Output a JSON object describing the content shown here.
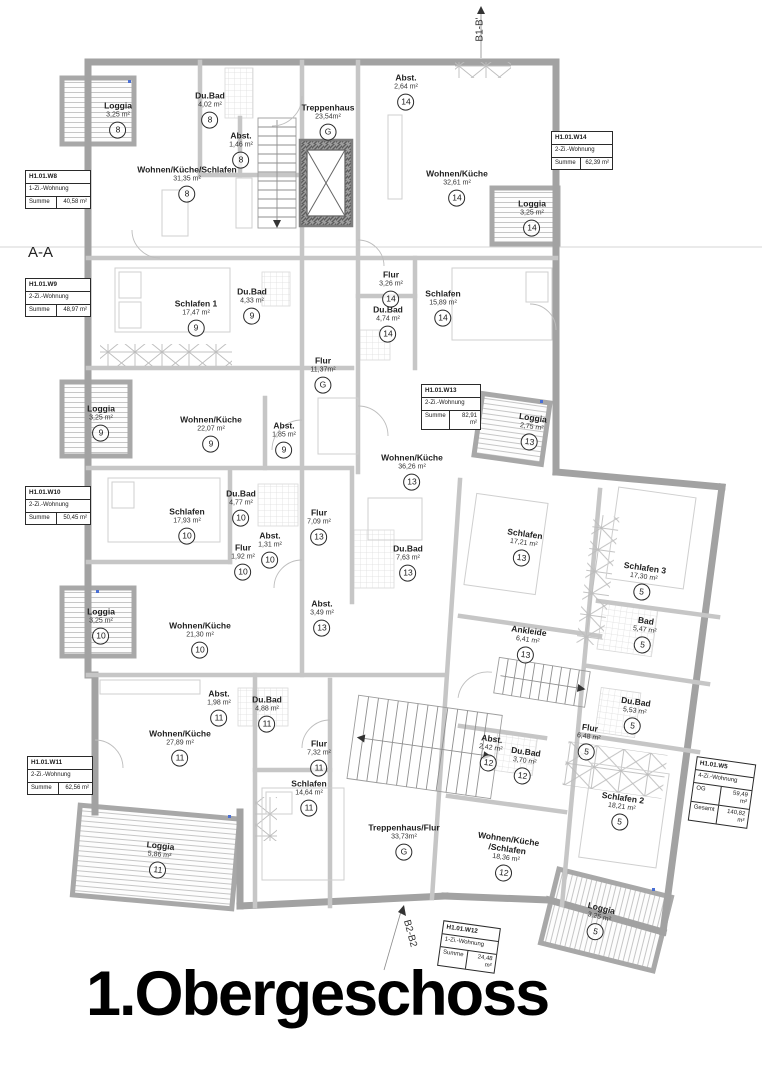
{
  "title": "1.Obergeschoss",
  "section_labels": {
    "aa": "A-A",
    "b1": "B1-B'",
    "b2": "B2-B2"
  },
  "apartment_boxes": [
    {
      "id": "H1.01.W8",
      "type": "1-Zi.-Wohnung",
      "rows": [
        [
          "Summe",
          "40,58 m²"
        ]
      ],
      "x": 25,
      "y": 170,
      "rot": 0,
      "w": 64
    },
    {
      "id": "H1.01.W9",
      "type": "2-Zi.-Wohnung",
      "rows": [
        [
          "Summe",
          "48,97 m²"
        ]
      ],
      "x": 25,
      "y": 278,
      "rot": 0,
      "w": 64
    },
    {
      "id": "H1.01.W10",
      "type": "2-Zi.-Wohnung",
      "rows": [
        [
          "Summe",
          "50,45 m²"
        ]
      ],
      "x": 25,
      "y": 486,
      "rot": 0,
      "w": 64
    },
    {
      "id": "H1.01.W11",
      "type": "2-Zi.-Wohnung",
      "rows": [
        [
          "Summe",
          "62,56 m²"
        ]
      ],
      "x": 27,
      "y": 756,
      "rot": 0,
      "w": 64
    },
    {
      "id": "H1.01.W13",
      "type": "2-Zi.-Wohnung",
      "rows": [
        [
          "Summe",
          "82,91 m²"
        ]
      ],
      "x": 421,
      "y": 384,
      "rot": 0,
      "w": 58
    },
    {
      "id": "H1.01.W14",
      "type": "2-Zi.-Wohnung",
      "rows": [
        [
          "Summe",
          "62,39 m²"
        ]
      ],
      "x": 551,
      "y": 131,
      "rot": 0,
      "w": 60
    },
    {
      "id": "H1.01.W5",
      "type": "4-Zi.-Wohnung",
      "rows": [
        [
          "OG",
          "59,49 m²"
        ],
        [
          "Gesamt",
          "140,82 m²"
        ]
      ],
      "x": 692,
      "y": 760,
      "rot": 8,
      "w": 58
    },
    {
      "id": "H1.01.W12",
      "type": "1-Zi.-Wohnung",
      "rows": [
        [
          "Summe",
          "24,48 m²"
        ]
      ],
      "x": 440,
      "y": 924,
      "rot": 8,
      "w": 56
    }
  ],
  "rooms": [
    {
      "name": "Loggia",
      "area": "3,25 m²",
      "unit": "8",
      "x": 118,
      "y": 120,
      "rot": 0
    },
    {
      "name": "Du.Bad",
      "area": "4,02 m²",
      "unit": "8",
      "x": 210,
      "y": 110,
      "rot": 0
    },
    {
      "name": "Abst.",
      "area": "1,46 m²",
      "unit": "8",
      "x": 241,
      "y": 150,
      "rot": 0
    },
    {
      "name": "Wohnen/Küche/Schlafen",
      "area": "31,35 m²",
      "unit": "8",
      "x": 187,
      "y": 184,
      "rot": 0
    },
    {
      "name": "Treppenhaus",
      "area": "23,54m²",
      "unit": "G",
      "x": 328,
      "y": 122,
      "rot": 0
    },
    {
      "name": "Abst.",
      "area": "2,64 m²",
      "unit": "14",
      "x": 406,
      "y": 92,
      "rot": 0
    },
    {
      "name": "Wohnen/Küche",
      "area": "32,61 m²",
      "unit": "14",
      "x": 457,
      "y": 188,
      "rot": 0
    },
    {
      "name": "Loggia",
      "area": "3,25 m²",
      "unit": "14",
      "x": 532,
      "y": 218,
      "rot": 0
    },
    {
      "name": "Schlafen 1",
      "area": "17,47 m²",
      "unit": "9",
      "x": 196,
      "y": 318,
      "rot": 0
    },
    {
      "name": "Du.Bad",
      "area": "4,33 m²",
      "unit": "9",
      "x": 252,
      "y": 306,
      "rot": 0
    },
    {
      "name": "Flur",
      "area": "3,26 m²",
      "unit": "14",
      "x": 391,
      "y": 289,
      "rot": 0
    },
    {
      "name": "Du.Bad",
      "area": "4,74 m²",
      "unit": "14",
      "x": 388,
      "y": 324,
      "rot": 0
    },
    {
      "name": "Schlafen",
      "area": "15,89 m²",
      "unit": "14",
      "x": 443,
      "y": 308,
      "rot": 0
    },
    {
      "name": "Flur",
      "area": "11,37m²",
      "unit": "G",
      "x": 323,
      "y": 375,
      "rot": 0
    },
    {
      "name": "Loggia",
      "area": "3,25 m²",
      "unit": "9",
      "x": 101,
      "y": 423,
      "rot": 0
    },
    {
      "name": "Wohnen/Küche",
      "area": "22,07 m²",
      "unit": "9",
      "x": 211,
      "y": 434,
      "rot": 0
    },
    {
      "name": "Abst.",
      "area": "1,85 m²",
      "unit": "9",
      "x": 284,
      "y": 440,
      "rot": 0
    },
    {
      "name": "Wohnen/Küche",
      "area": "36,26 m²",
      "unit": "13",
      "x": 412,
      "y": 472,
      "rot": 0
    },
    {
      "name": "Loggia",
      "area": "2,75 m²",
      "unit": "13",
      "x": 531,
      "y": 432,
      "rot": 8
    },
    {
      "name": "Schlafen",
      "area": "17,93 m²",
      "unit": "10",
      "x": 187,
      "y": 526,
      "rot": 0
    },
    {
      "name": "Du.Bad",
      "area": "4,77 m²",
      "unit": "10",
      "x": 241,
      "y": 508,
      "rot": 0
    },
    {
      "name": "Abst.",
      "area": "1,31 m²",
      "unit": "10",
      "x": 270,
      "y": 550,
      "rot": 0
    },
    {
      "name": "Flur",
      "area": "1,92 m²",
      "unit": "10",
      "x": 243,
      "y": 562,
      "rot": 0
    },
    {
      "name": "Flur",
      "area": "7,09 m²",
      "unit": "13",
      "x": 319,
      "y": 527,
      "rot": 0
    },
    {
      "name": "Du.Bad",
      "area": "7,63 m²",
      "unit": "13",
      "x": 408,
      "y": 563,
      "rot": 0
    },
    {
      "name": "Schlafen",
      "area": "17,21 m²",
      "unit": "13",
      "x": 523,
      "y": 548,
      "rot": 8
    },
    {
      "name": "Loggia",
      "area": "3,25 m²",
      "unit": "10",
      "x": 101,
      "y": 626,
      "rot": 0
    },
    {
      "name": "Abst.",
      "area": "3,49 m²",
      "unit": "13",
      "x": 322,
      "y": 618,
      "rot": 0
    },
    {
      "name": "Wohnen/Küche",
      "area": "21,30 m²",
      "unit": "10",
      "x": 200,
      "y": 640,
      "rot": 0
    },
    {
      "name": "Ankleide",
      "area": "6,41 m²",
      "unit": "13",
      "x": 527,
      "y": 645,
      "rot": 8
    },
    {
      "name": "Schlafen 3",
      "area": "17,30 m²",
      "unit": "5",
      "x": 643,
      "y": 582,
      "rot": 8
    },
    {
      "name": "Bad",
      "area": "5,47 m²",
      "unit": "5",
      "x": 644,
      "y": 635,
      "rot": 8
    },
    {
      "name": "Du.Bad",
      "area": "5,53 m²",
      "unit": "5",
      "x": 634,
      "y": 716,
      "rot": 8
    },
    {
      "name": "Flur",
      "area": "6,48 m²",
      "unit": "5",
      "x": 588,
      "y": 742,
      "rot": 8
    },
    {
      "name": "Schlafen 2",
      "area": "18,21 m²",
      "unit": "5",
      "x": 621,
      "y": 812,
      "rot": 8
    },
    {
      "name": "Abst.",
      "area": "1,98 m²",
      "unit": "11",
      "x": 219,
      "y": 708,
      "rot": 0
    },
    {
      "name": "Du.Bad",
      "area": "4,88 m²",
      "unit": "11",
      "x": 267,
      "y": 714,
      "rot": 0
    },
    {
      "name": "Wohnen/Küche",
      "area": "27,89 m²",
      "unit": "11",
      "x": 180,
      "y": 748,
      "rot": 0
    },
    {
      "name": "Flur",
      "area": "7,32 m²",
      "unit": "11",
      "x": 319,
      "y": 758,
      "rot": 0
    },
    {
      "name": "Schlafen",
      "area": "14,64 m²",
      "unit": "11",
      "x": 309,
      "y": 798,
      "rot": 0
    },
    {
      "name": "Treppenhaus/Flur",
      "area": "33,73m²",
      "unit": "G",
      "x": 404,
      "y": 842,
      "rot": 0
    },
    {
      "name": "Abst.",
      "area": "2,42 m²",
      "unit": "12",
      "x": 490,
      "y": 753,
      "rot": 8
    },
    {
      "name": "Du.Bad",
      "area": "3,70 m²",
      "unit": "12",
      "x": 524,
      "y": 766,
      "rot": 8
    },
    {
      "name": "Wohnen/Küche",
      "name2": "/Schlafen",
      "area": "18,36 m²",
      "unit": "12",
      "x": 506,
      "y": 858,
      "rot": 8
    },
    {
      "name": "Loggia",
      "area": "5,86 m²",
      "unit": "11",
      "x": 159,
      "y": 860,
      "rot": 6
    },
    {
      "name": "Loggia",
      "area": "3,25 m²",
      "unit": "5",
      "x": 598,
      "y": 922,
      "rot": 14
    }
  ]
}
